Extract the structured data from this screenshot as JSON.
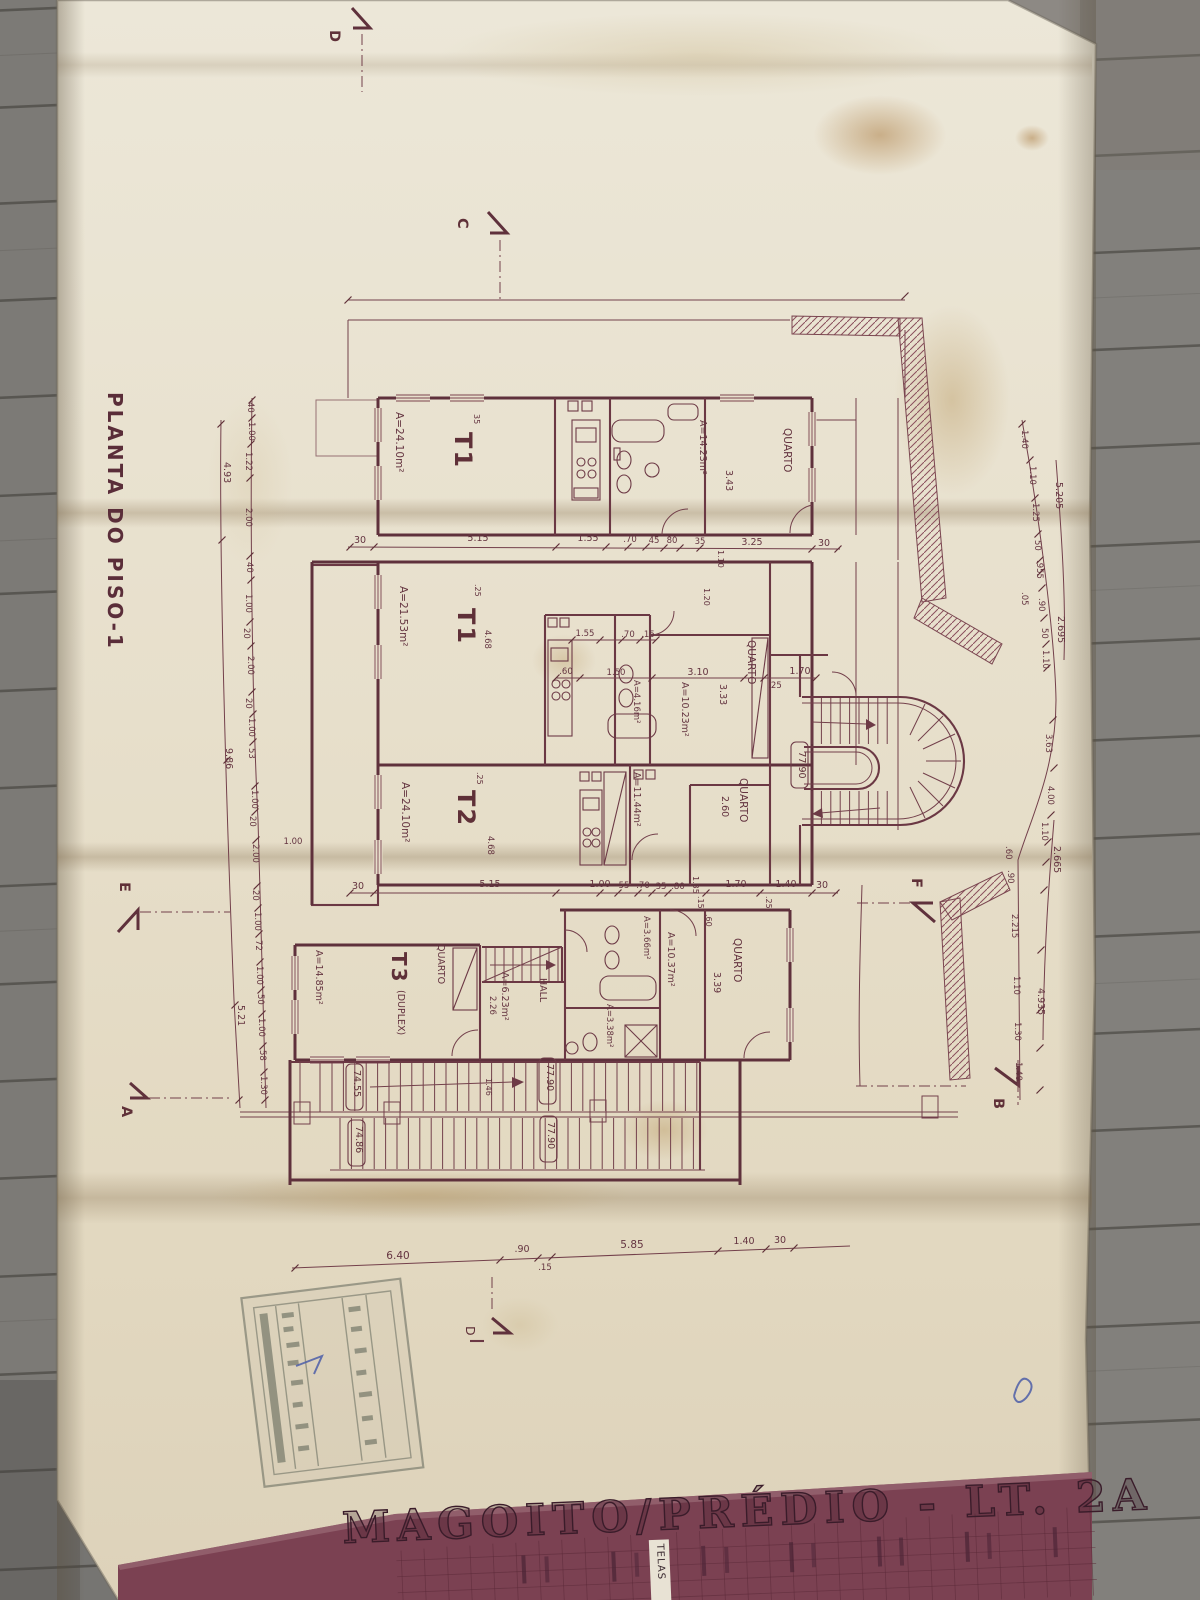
{
  "drawing": {
    "title": "PLANTA DO PISO-1",
    "apartments": {
      "t1a": {
        "name": "T1",
        "area": "A=24.10m²"
      },
      "t1b": {
        "name": "T1",
        "area": "A=21.53m²"
      },
      "t2": {
        "name": "T2",
        "area": "A=24.10m²"
      },
      "t3": {
        "name": "T3",
        "suffix": "(DUPLEX)",
        "area": "A=14.85m²"
      }
    },
    "rooms": {
      "quarto_top": {
        "name": "QUARTO",
        "area": "A=14.23m²",
        "width": "3.43"
      },
      "quarto_mid": {
        "name": "QUARTO",
        "area": "A=10.23m²",
        "width": "3.33"
      },
      "quarto_t2": {
        "name": "QUARTO",
        "width": "2.60"
      },
      "quarto_t3": {
        "name": "QUARTO"
      },
      "quarto_low": {
        "name": "QUARTO",
        "width": "3.39"
      },
      "room_1037": {
        "area": "A=10.37m²"
      },
      "hall": {
        "name": "HALL",
        "area": "A=6.23m²",
        "width": "2.26"
      },
      "bath_t1b": {
        "area": "A=4.16m²"
      },
      "kitchen_t2": {
        "area": "A=11.44m²"
      },
      "bath_t3_upper": {
        "area": "A=3.66m²"
      },
      "bath_t3_lower": {
        "area": "A=3.38m²"
      }
    },
    "levels": {
      "stair": "77.90",
      "landing_upper": "77.90",
      "landing_lower": "77.90",
      "flight_upper": "74.55",
      "flight_lower": "74.86"
    },
    "markers": {
      "a": "A",
      "b": "B",
      "c": "C",
      "d_top": "D",
      "d_bottom": "D",
      "e": "E",
      "f": "F"
    },
    "dims": {
      "top": [
        "30",
        "5.15",
        "1.55",
        ".70",
        "45",
        "80",
        "35",
        "3.25",
        "30"
      ],
      "kitchen": [
        "1.55",
        ".70",
        ".15"
      ],
      "mid": [
        ".60",
        "1.50",
        "3.10",
        ".25",
        "1.70"
      ],
      "row3": [
        "30",
        "5.15",
        "1.00",
        "55",
        ".70",
        "35",
        ".80",
        "1.70",
        "1.40",
        "30"
      ],
      "bottom": [
        "6.40",
        ".90",
        ".15",
        "5.85",
        "1.40",
        "30"
      ],
      "left": [
        "40",
        "1.00",
        "1.22",
        "2.00",
        "40",
        "1.00",
        "20",
        "2.00",
        "20",
        "1.00",
        "53",
        "1.00",
        "20",
        "2.00",
        "20",
        "1.00",
        "72",
        "1.00",
        "50",
        "1.00",
        "58",
        "1.30"
      ],
      "left_totals": [
        "4.93",
        "9.86",
        "5.21"
      ],
      "right": [
        "1.40",
        "1.10",
        "1.25",
        "50",
        ".955",
        ".05",
        ".90",
        "50",
        "1.10"
      ],
      "right_totals": [
        "5.205",
        "2.695",
        "2.665",
        "4.935"
      ],
      "right_lower": [
        "3.63",
        "4.00",
        "1.10",
        ".60",
        ".90",
        "2.215",
        "1.10",
        "1.30",
        "1.40"
      ],
      "inner": [
        "35",
        ".25",
        "4.68",
        "1.10",
        "1.20",
        ".25",
        "4.68",
        "1.35",
        ".15",
        ".60",
        ".25",
        "1.46",
        "1.00"
      ]
    },
    "title_block": {
      "project": "MAGOITO/PRÉDIO - LT. 2A",
      "chip": "TELAS"
    }
  }
}
